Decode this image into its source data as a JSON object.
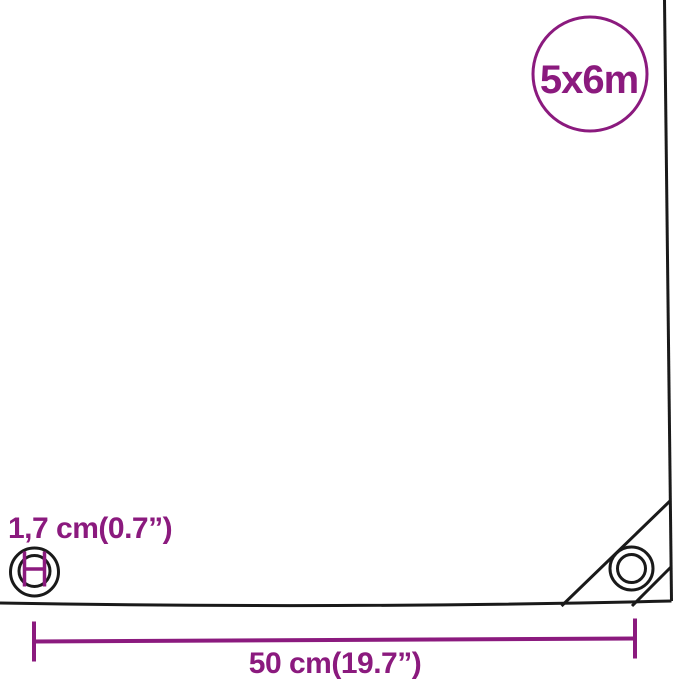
{
  "diagram": {
    "title": "tarpaulin-corner-measurement-diagram",
    "size_badge": {
      "label": "5x6m"
    },
    "grommet": {
      "diameter_label": "1,7 cm(0.7”)"
    },
    "corner_offset": {
      "width_label": "50 cm(19.7”)"
    }
  },
  "colors": {
    "accent": "#8B1A7E",
    "line": "#1A1A1A",
    "background": "#FFFFFF"
  },
  "icons": {
    "size_badge_circle": "circle-outline-badge",
    "grommet_diameter_icon": "grommet-rings-with-diameter-measure",
    "corner_grommet_icon": "concentric-grommet-rings",
    "width_measure_line": "horizontal-measure-line-with-end-ticks",
    "corner_fold": "diagonal-fold-lines"
  }
}
